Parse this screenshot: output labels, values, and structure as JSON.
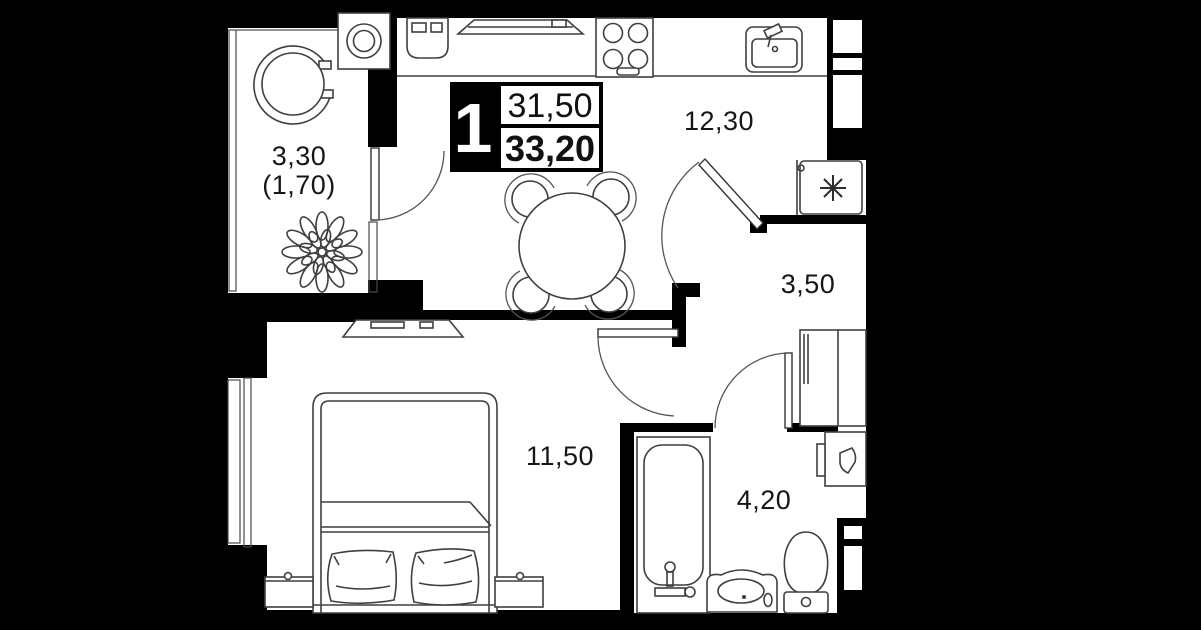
{
  "plan": {
    "unit_badge": {
      "rooms_count": "1",
      "living_area": "31,50",
      "total_area": "33,20"
    },
    "rooms": {
      "kitchen_living": {
        "area": "12,30"
      },
      "hallway": {
        "area": "3,50"
      },
      "bedroom": {
        "area": "11,50"
      },
      "bathroom": {
        "area": "4,20"
      },
      "balcony": {
        "area": "3,30",
        "area_reduced": "(1,70)"
      }
    },
    "colors": {
      "background": "#000000",
      "floor": "#ffffff",
      "walls": "#000000",
      "furniture_line": "#3f3f3f",
      "label_text": "#161616"
    }
  }
}
